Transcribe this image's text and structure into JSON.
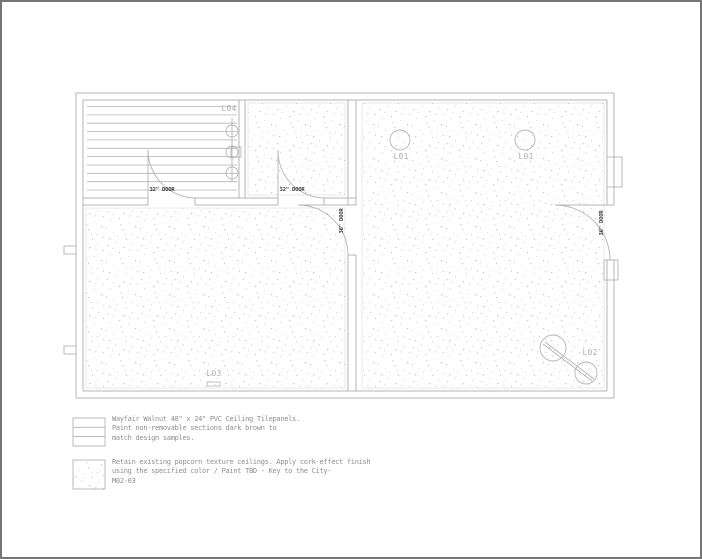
{
  "plan": {
    "room_labels": {
      "l04": "L04",
      "l01_left": "L01",
      "l01_right": "L01",
      "l02": "L02",
      "l03": "L03"
    },
    "door_labels": {
      "left_32": "32\" DOOR",
      "mid_32": "32\" DOOR",
      "mid_36": "36\" DOOR",
      "right_36": "36\" DOOR"
    }
  },
  "legend": {
    "items": [
      {
        "swatch": "walnut-panel-striped-swatch",
        "lines": [
          "Wayfair Walnut 48\" x 24\" PVC Ceiling Tilepanels.",
          "Paint non-removable sections dark brown to",
          "match design samples."
        ]
      },
      {
        "swatch": "popcorn-texture-stipple-swatch",
        "lines": [
          "Retain existing popcorn texture ceilings. Apply cork-effect finish",
          "using the specified color / Paint TBD - Key to the City-",
          "M02-03"
        ]
      }
    ]
  },
  "colors": {
    "background": "#ffffff",
    "page_border": "#757575",
    "wall_line": "#b4b4b4",
    "hatch_boundary": "#dcdcdc",
    "stipple_dot": "#c6c6c6",
    "door_text": "#3d3d3d",
    "room_label_text": "#aeaeae",
    "legend_text": "#8f8f8f"
  }
}
